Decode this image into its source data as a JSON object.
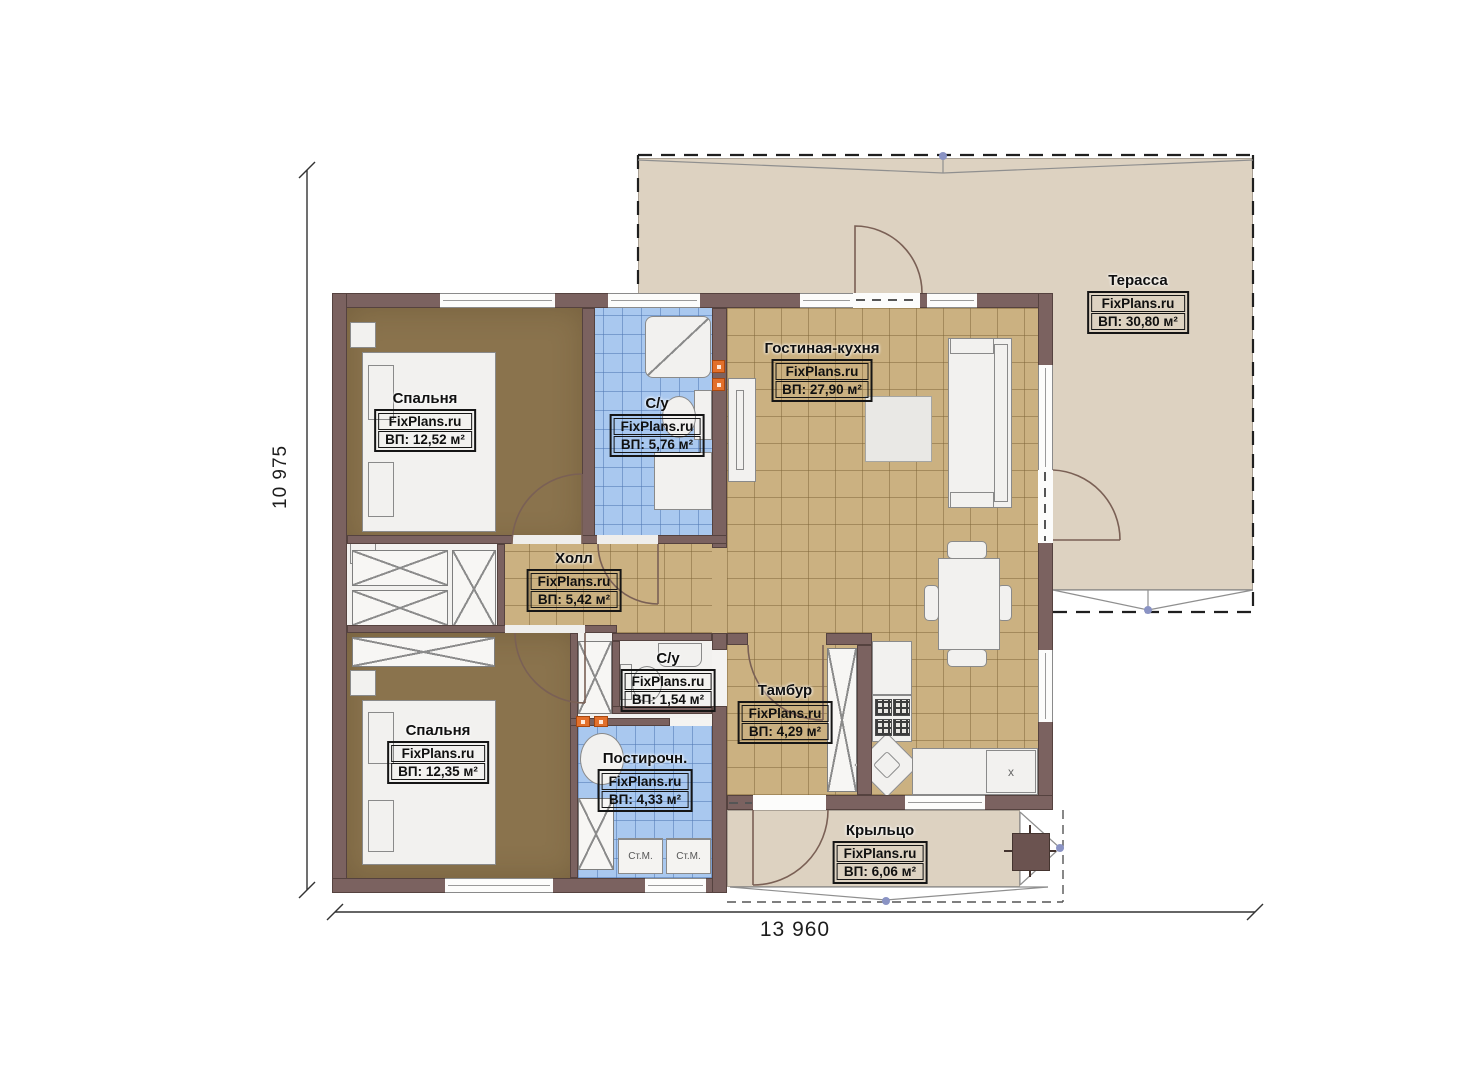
{
  "plan": {
    "brand": "FixPlans.ru",
    "rooms": {
      "bedroom1": {
        "name": "Спальня",
        "area": "ВП: 12,52 м²"
      },
      "bath1": {
        "name": "С/у",
        "area": "ВП: 5,76 м²"
      },
      "living": {
        "name": "Гостиная-кухня",
        "area": "ВП: 27,90 м²"
      },
      "terrace": {
        "name": "Терасса",
        "area": "ВП: 30,80 м²"
      },
      "hall": {
        "name": "Холл",
        "area": "ВП: 5,42 м²"
      },
      "bedroom2": {
        "name": "Спальня",
        "area": "ВП: 12,35 м²"
      },
      "bath2": {
        "name": "С/у",
        "area": "ВП: 1,54 м²"
      },
      "laundry": {
        "name": "Постирочн.",
        "area": "ВП: 4,33 м²"
      },
      "tambour": {
        "name": "Тамбур",
        "area": "ВП: 4,29 м²"
      },
      "porch": {
        "name": "Крыльцо",
        "area": "ВП: 6,06 м²"
      }
    },
    "dimensions": {
      "height": "10 975",
      "width": "13 960"
    },
    "appliances": {
      "washer": "Ст.М.",
      "counter_x": "x"
    },
    "colors": {
      "wall": "#7b6260",
      "tile_tan": "#cbb181",
      "tile_blue": "#a9c8ef",
      "floor_brown": "#8a734d",
      "terrace_beige": "#ddd2c1",
      "marker_orange": "#e2702c"
    }
  }
}
